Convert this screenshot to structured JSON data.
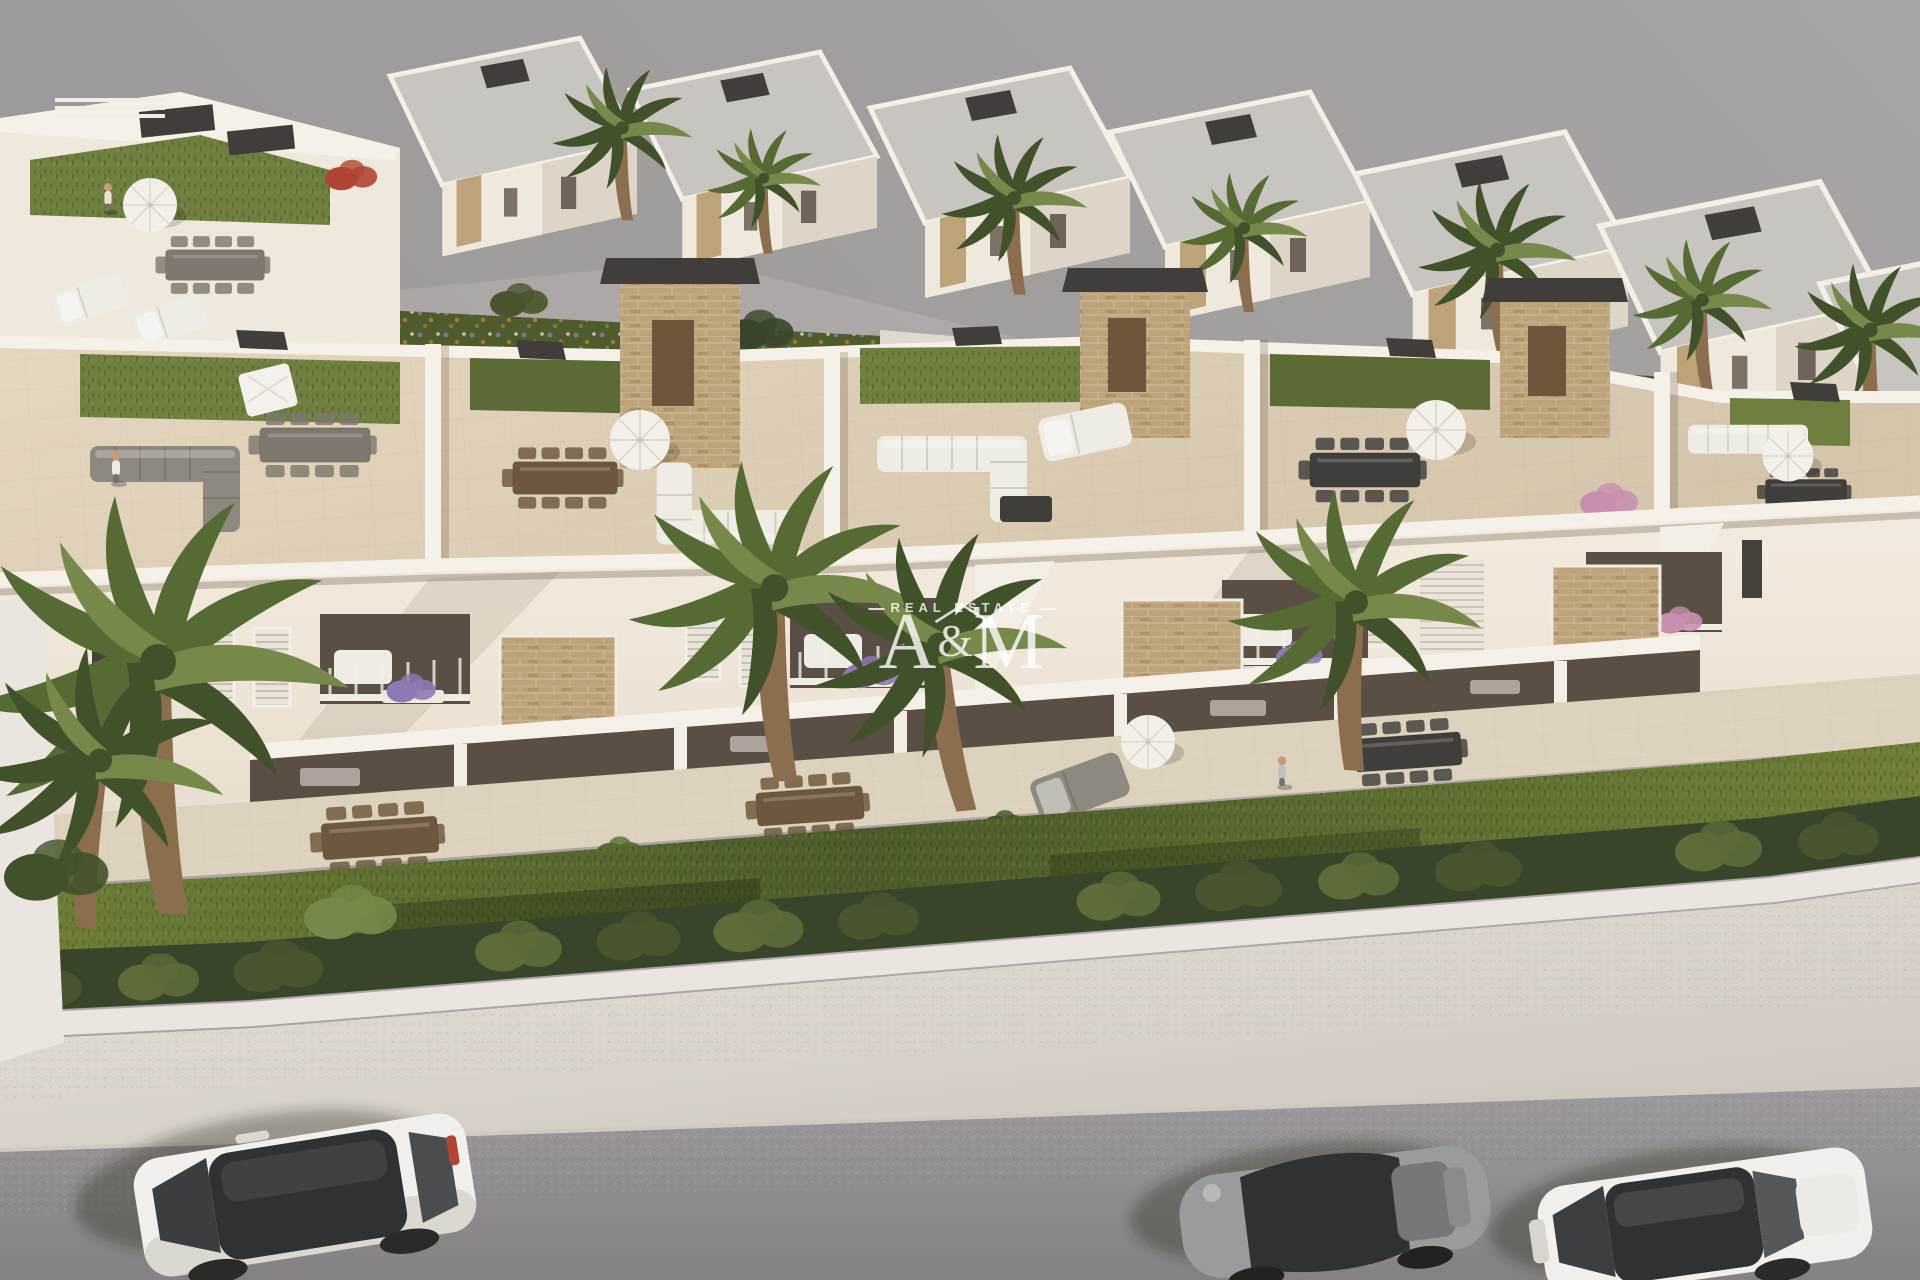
{
  "image": {
    "kind": "3d-architectural-render",
    "view": "aerial-oblique"
  },
  "watermark": {
    "icon": "house-roof-icon",
    "top_label": "REAL ESTATE",
    "letter_a": "A",
    "ampersand": "&",
    "letter_m": "M"
  },
  "scene": {
    "cars": [
      "white-suv",
      "gray-sports-coupe",
      "white-sedan"
    ],
    "vegetation": [
      "palm-trees",
      "trimmed-hedge-row",
      "lawn",
      "flower-beds"
    ],
    "buildings": [
      "back-villa-row",
      "rooftop-solarium-terraces",
      "white-townhouse-facade"
    ]
  },
  "colors": {
    "sky_top": "#a8a4a3",
    "sky": "#9b9798",
    "road_top": "#9e9a9b",
    "road_bottom": "#858182",
    "curb": "#cfc9c1",
    "pavement_light": "#e7e2d9",
    "pavement": "#cdc7be",
    "wall_white": "#eae6df",
    "lawn_light": "#6f7f38",
    "lawn_dark": "#4d5c2a",
    "hedge": "#49552e",
    "hedge_dark": "#39452a",
    "hedge_light": "#5d6c38",
    "turf": "#6f7f40",
    "turf_dark": "#5c6b35",
    "roof_floor_light": "#e4d7bf",
    "roof_floor": "#d4c5ab",
    "parapet": "#f6f1e8",
    "facade_light": "#f2ebdf",
    "facade": "#e9dfd0",
    "facade_shade": "#d9ccba",
    "recess_dark": "#594f44",
    "opening_dark": "#46413b",
    "stone": "#bda379",
    "stone_dark": "#a3885f",
    "charcoal": "#413d3a",
    "wood": "#8a6e4d",
    "wood_dark": "#6f563b",
    "villa_wall": "#eee8dd",
    "roof_gray": "#c8c4bf",
    "palm": "#566b33",
    "palm_dark": "#41522a",
    "palm_light": "#76894a",
    "sofa_gray": "#8e897f",
    "sofa_white": "#efece4",
    "table_brown": "#6e5740",
    "table_dark": "#403e3b",
    "table_gray": "#7e786e",
    "daybed_cream": "#e7e2d6",
    "flower_purple": "#8d7ab5",
    "flower_pink": "#c98fae",
    "flower_red": "#b04534",
    "flower_orange": "#c27b42",
    "car_white": "#f2f0ec",
    "car_glass": "#2f3133",
    "car_gray": "#9b9a9c",
    "skin": "#c79a75",
    "watermark": "rgba(255,255,255,0.8)"
  }
}
